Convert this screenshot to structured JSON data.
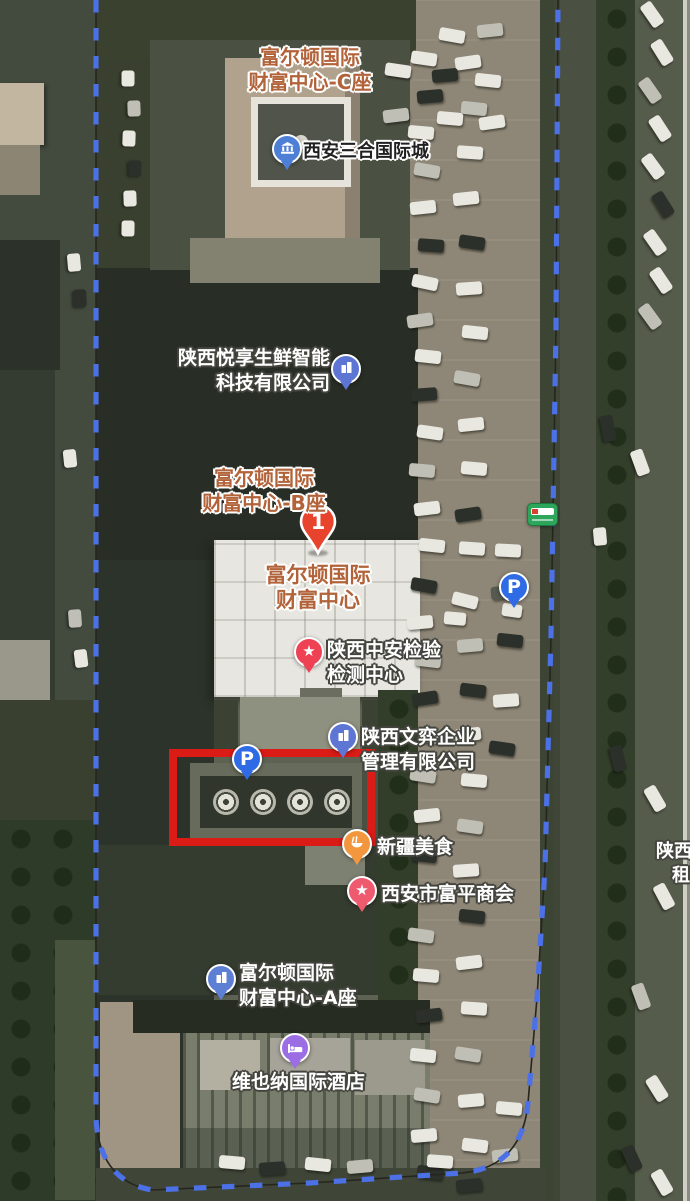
{
  "markers": {
    "tower_c": {
      "line1": "富尔顿国际",
      "line2": "财富中心-C座"
    },
    "sanhe": {
      "label": "西安三合国际城"
    },
    "yuexiang": {
      "line1": "陕西悦享生鲜智能",
      "line2": "科技有限公司"
    },
    "tower_b": {
      "line1": "富尔顿国际",
      "line2": "财富中心-B座"
    },
    "selected": {
      "number": "1",
      "line1": "富尔顿国际",
      "line2": "财富中心"
    },
    "zhongan": {
      "line1": "陕西中安检验",
      "line2": "检测中心"
    },
    "wenyi": {
      "line1": "陕西文弈企业",
      "line2": "管理有限公司"
    },
    "parking_main": {
      "label": "P"
    },
    "parking_right": {
      "label": "P"
    },
    "xinjiang": {
      "label": "新疆美食"
    },
    "fuping": {
      "label": "西安市富平商会"
    },
    "tower_a": {
      "line1": "富尔顿国际",
      "line2": "财富中心-A座"
    },
    "vienna": {
      "label": "维也纳国际酒店"
    },
    "edge": {
      "line1": "陕西",
      "line2": "租"
    }
  },
  "icons": {
    "star": "★"
  },
  "annotation": {
    "type": "rectangle",
    "color": "#da1b16"
  },
  "boundary": {
    "style": "dashed",
    "color": "#4c70e6"
  },
  "colors": {
    "label_orange": "#b2633a",
    "pin_blue_building": "#5d76d3",
    "pin_red_star": "#ee4254",
    "pin_pink_star": "#ee5b6e",
    "pin_parking": "#2e6be4",
    "pin_food_orange": "#f2973d",
    "pin_hotel_purple": "#9c6ee4",
    "marker_red": "#e8432d",
    "bus_green": "#2ca65b"
  },
  "decor": {
    "car_colors": [
      "#e8e7e0",
      "#bfbfb6",
      "#2c302a",
      "#888b7e",
      "#565a50"
    ],
    "cars": [
      [
        424,
        58,
        8,
        0
      ],
      [
        430,
        96,
        -5,
        2
      ],
      [
        421,
        132,
        5,
        0
      ],
      [
        427,
        170,
        10,
        1
      ],
      [
        423,
        207,
        -6,
        0
      ],
      [
        431,
        245,
        4,
        2
      ],
      [
        425,
        282,
        12,
        0
      ],
      [
        420,
        320,
        -8,
        1
      ],
      [
        428,
        356,
        6,
        0
      ],
      [
        424,
        394,
        -4,
        2
      ],
      [
        430,
        432,
        8,
        0
      ],
      [
        422,
        470,
        5,
        1
      ],
      [
        427,
        508,
        -7,
        0
      ],
      [
        432,
        545,
        6,
        0
      ],
      [
        424,
        585,
        10,
        2
      ],
      [
        420,
        622,
        -5,
        0
      ],
      [
        428,
        660,
        7,
        1
      ],
      [
        425,
        698,
        -8,
        2
      ],
      [
        431,
        736,
        5,
        0
      ],
      [
        423,
        775,
        9,
        1
      ],
      [
        427,
        815,
        -6,
        0
      ],
      [
        424,
        855,
        6,
        2
      ],
      [
        430,
        895,
        -4,
        0
      ],
      [
        421,
        935,
        8,
        1
      ],
      [
        426,
        975,
        5,
        0
      ],
      [
        429,
        1015,
        -7,
        2
      ],
      [
        423,
        1055,
        6,
        0
      ],
      [
        427,
        1095,
        9,
        1
      ],
      [
        424,
        1135,
        -5,
        0
      ],
      [
        430,
        1172,
        6,
        2
      ],
      [
        468,
        62,
        -8,
        0
      ],
      [
        474,
        108,
        6,
        1
      ],
      [
        470,
        152,
        4,
        0
      ],
      [
        466,
        198,
        -6,
        0
      ],
      [
        472,
        242,
        8,
        2
      ],
      [
        469,
        288,
        -4,
        0
      ],
      [
        475,
        332,
        6,
        0
      ],
      [
        467,
        378,
        10,
        1
      ],
      [
        471,
        424,
        -6,
        0
      ],
      [
        474,
        468,
        5,
        0
      ],
      [
        468,
        514,
        -8,
        2
      ],
      [
        472,
        548,
        4,
        0
      ],
      [
        465,
        600,
        14,
        0
      ],
      [
        470,
        645,
        -5,
        1
      ],
      [
        473,
        690,
        7,
        2
      ],
      [
        468,
        734,
        -6,
        0
      ],
      [
        474,
        780,
        5,
        0
      ],
      [
        470,
        826,
        8,
        1
      ],
      [
        466,
        870,
        -4,
        0
      ],
      [
        472,
        916,
        6,
        2
      ],
      [
        469,
        962,
        -7,
        0
      ],
      [
        474,
        1008,
        4,
        0
      ],
      [
        468,
        1054,
        9,
        1
      ],
      [
        471,
        1100,
        -5,
        0
      ],
      [
        475,
        1145,
        7,
        0
      ],
      [
        469,
        1185,
        -6,
        2
      ],
      [
        508,
        550,
        3,
        0
      ],
      [
        504,
        592,
        -5,
        4
      ],
      [
        510,
        640,
        6,
        2
      ],
      [
        506,
        700,
        -4,
        0
      ],
      [
        502,
        748,
        8,
        2
      ],
      [
        509,
        1108,
        5,
        0
      ],
      [
        505,
        1155,
        -6,
        1
      ],
      [
        512,
        610,
        8,
        0,
        20
      ],
      [
        455,
        618,
        5,
        0,
        22
      ],
      [
        452,
        35,
        10,
        0
      ],
      [
        490,
        30,
        -6,
        1
      ],
      [
        398,
        70,
        8,
        0
      ],
      [
        445,
        75,
        -5,
        2
      ],
      [
        488,
        80,
        6,
        0
      ],
      [
        396,
        115,
        -7,
        1
      ],
      [
        450,
        118,
        5,
        0
      ],
      [
        492,
        122,
        -8,
        0
      ],
      [
        128,
        78,
        90,
        0,
        16
      ],
      [
        134,
        108,
        88,
        1,
        16
      ],
      [
        129,
        138,
        92,
        0,
        16
      ],
      [
        135,
        168,
        90,
        2,
        16
      ],
      [
        130,
        198,
        88,
        0,
        16
      ],
      [
        128,
        228,
        91,
        0,
        16
      ],
      [
        652,
        14,
        55,
        0
      ],
      [
        662,
        52,
        58,
        0
      ],
      [
        650,
        90,
        55,
        1
      ],
      [
        660,
        128,
        57,
        0
      ],
      [
        653,
        166,
        54,
        0
      ],
      [
        663,
        204,
        58,
        2
      ],
      [
        655,
        242,
        55,
        0
      ],
      [
        661,
        280,
        56,
        0
      ],
      [
        650,
        316,
        54,
        1
      ],
      [
        608,
        428,
        80,
        2
      ],
      [
        640,
        462,
        70,
        0
      ],
      [
        600,
        536,
        85,
        0,
        18
      ],
      [
        618,
        758,
        75,
        2
      ],
      [
        655,
        798,
        60,
        0
      ],
      [
        664,
        896,
        62,
        0
      ],
      [
        641,
        996,
        70,
        1
      ],
      [
        657,
        1088,
        58,
        0
      ],
      [
        632,
        1158,
        65,
        2
      ],
      [
        662,
        1182,
        60,
        0
      ],
      [
        74,
        262,
        85,
        0,
        18
      ],
      [
        80,
        298,
        88,
        2,
        18
      ],
      [
        70,
        458,
        84,
        0,
        18
      ],
      [
        75,
        618,
        86,
        1,
        18
      ],
      [
        81,
        658,
        83,
        0,
        18
      ],
      [
        232,
        1162,
        5,
        0
      ],
      [
        272,
        1168,
        -4,
        2
      ],
      [
        318,
        1164,
        6,
        0
      ],
      [
        360,
        1166,
        -5,
        1
      ],
      [
        440,
        1161,
        4,
        0
      ]
    ]
  }
}
